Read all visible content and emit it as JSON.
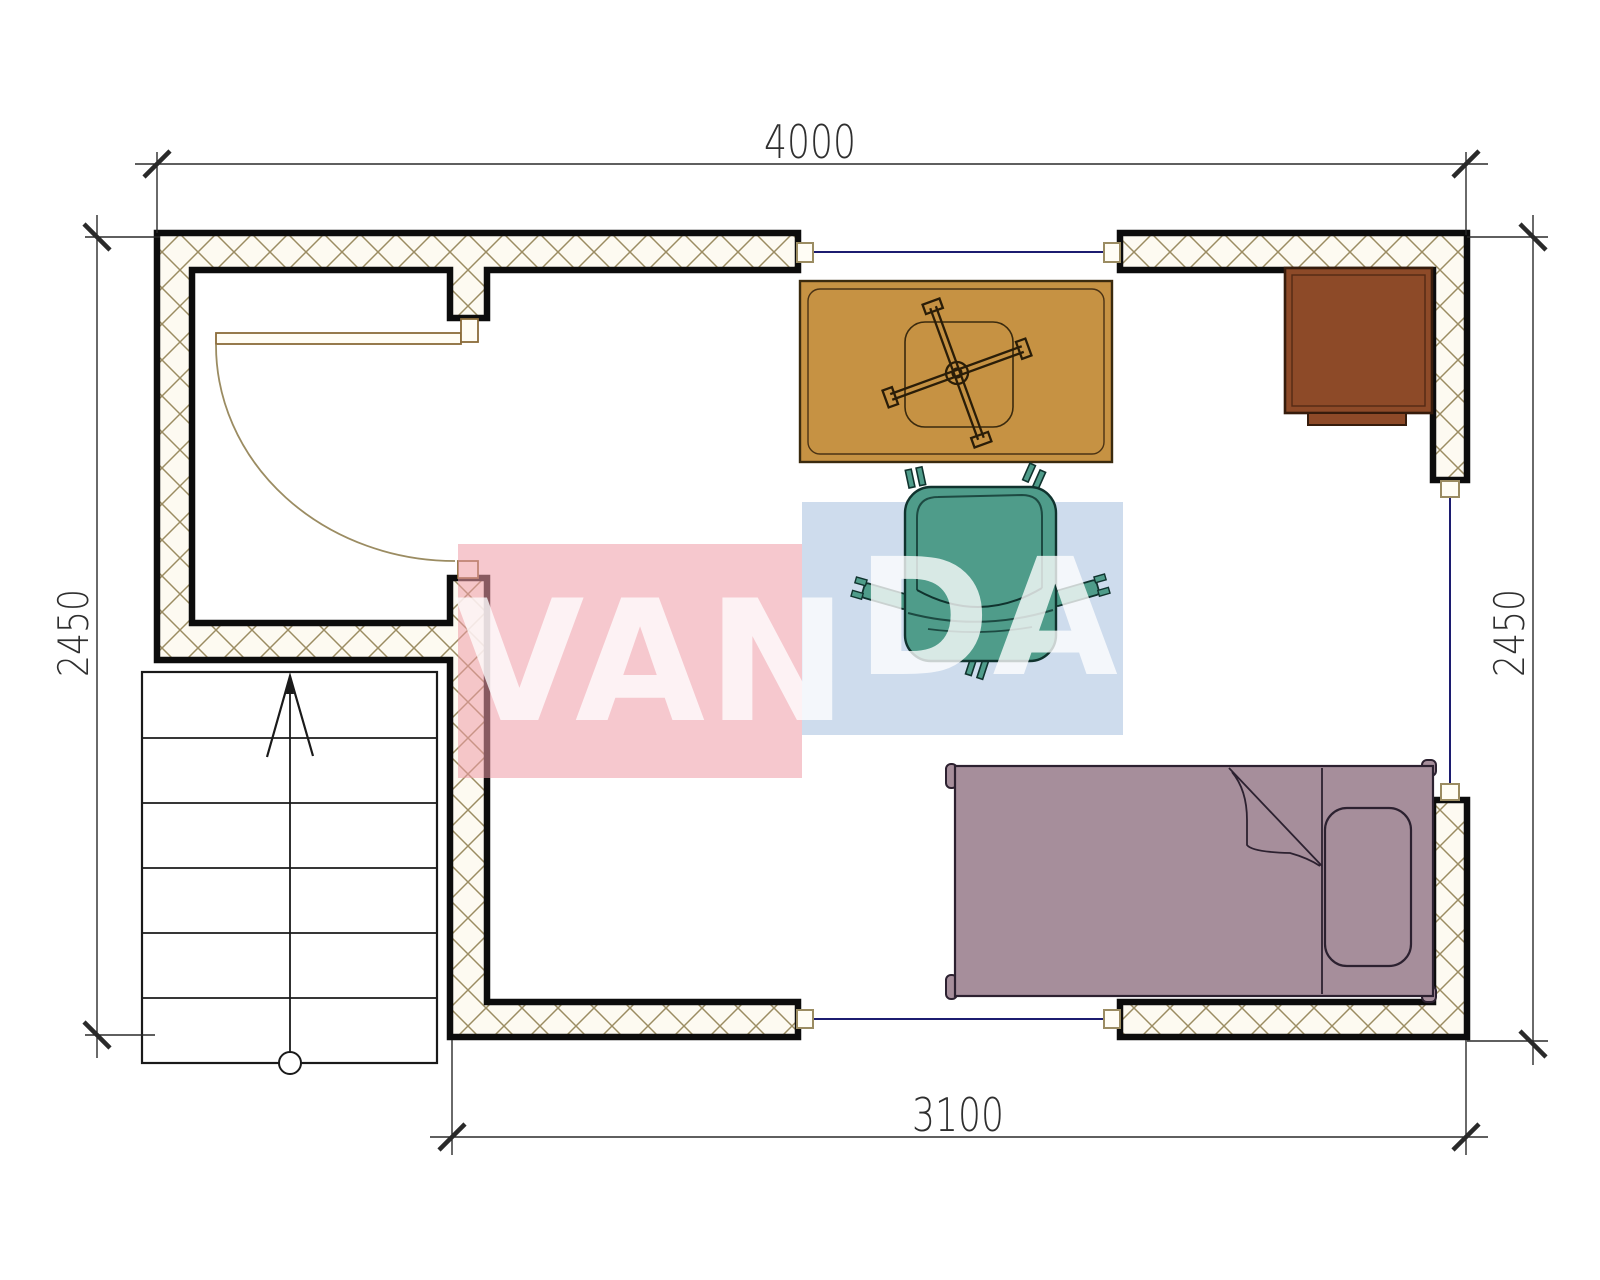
{
  "drawing": {
    "type": "floor-plan",
    "rooms": "studio with entry hall, staircase, main room"
  },
  "dimensions": {
    "top": "4000",
    "bottom": "3100",
    "left": "2450",
    "right": "2450"
  },
  "watermark": {
    "word": "VANDA",
    "part_left": "VAN",
    "part_right": "DA",
    "letter_color": "#ffffff",
    "red_block_color": "#ef9aa6",
    "blue_block_color": "#9db9dc"
  },
  "colors": {
    "wall_fill": "#fdfaf1",
    "hatch_line": "#9b8c62",
    "wall_edge": "#0c0c0c",
    "window_line": "#1c1c70",
    "door_line": "#8b6b3a",
    "arc_line": "#9b8c62",
    "connector_fill": "#fffdf5",
    "table_fill": "#c69243",
    "table_line": "#3a2a0e",
    "cabinet_fill": "#8d4a28",
    "cabinet_line": "#361c0c",
    "chair_fill": "#4f9c8a",
    "chair_line": "#10332e",
    "chair_seam": "#1d4a42",
    "bed_fill": "#a68e9b",
    "bed_line": "#2c2130",
    "stair_line": "#1a1a1a",
    "dim_line": "#2a2a2a"
  }
}
